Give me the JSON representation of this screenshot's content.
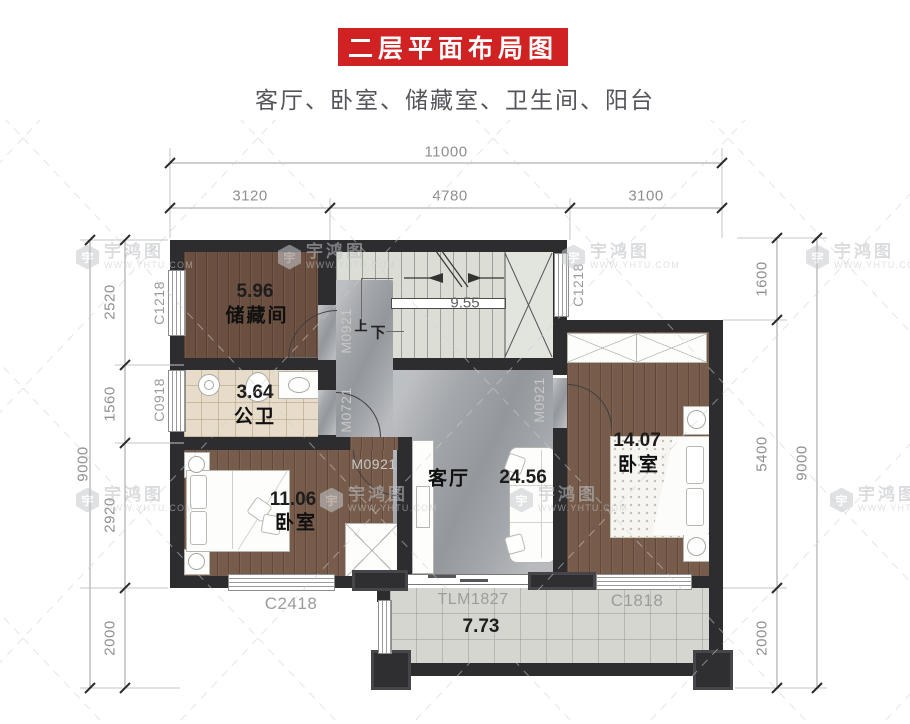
{
  "header": {
    "title": "二层平面布局图",
    "subtitle": "客厅、卧室、储藏室、卫生间、阳台",
    "banner_color": "#d02222"
  },
  "watermark": {
    "brand": "宇鸿图",
    "url": "WWW.YHTU.COM",
    "icon": "hexagon-logo"
  },
  "rooms": {
    "storage": {
      "area": "5.96",
      "name": "储藏间"
    },
    "bathroom": {
      "area": "3.64",
      "name": "公卫"
    },
    "bedroom_left": {
      "area": "11.06",
      "name": "卧室"
    },
    "living": {
      "area": "24.56",
      "name": "客厅"
    },
    "bedroom_right": {
      "area": "14.07",
      "name": "卧室"
    },
    "balcony": {
      "area": "7.73"
    },
    "stairs": {
      "area": "9.55",
      "up": "上",
      "down": "下"
    }
  },
  "openings": {
    "window_c1218_left": "C1218",
    "window_c0918_bath": "C0918",
    "window_c1218_stair": "C1218",
    "door_m0921_storage": "M0921",
    "door_m0721_bath": "M0721",
    "door_m0921_bedroom_left": "M0921",
    "door_m0921_bedroom_right": "M0921",
    "window_c2418": "C2418",
    "door_tlm1827_balcony": "TLM1827",
    "window_c1818": "C1818"
  },
  "dimensions": {
    "top": {
      "total": "11000",
      "segments": [
        "3120",
        "4780",
        "3100"
      ]
    },
    "left": {
      "total": "9000",
      "segments": [
        "2520",
        "1560",
        "2920",
        "2000"
      ]
    },
    "right": {
      "total": "9000",
      "segments": [
        "1600",
        "5400",
        "2000"
      ]
    }
  },
  "colors": {
    "wall": "#2d2d30",
    "wood_floor": "#775c4b",
    "marble_floor": "#a4a7ab",
    "bath_tile": "#e6dcc9",
    "balcony_tile": "#d6d6d1",
    "stair_tread": "#dcded6"
  }
}
